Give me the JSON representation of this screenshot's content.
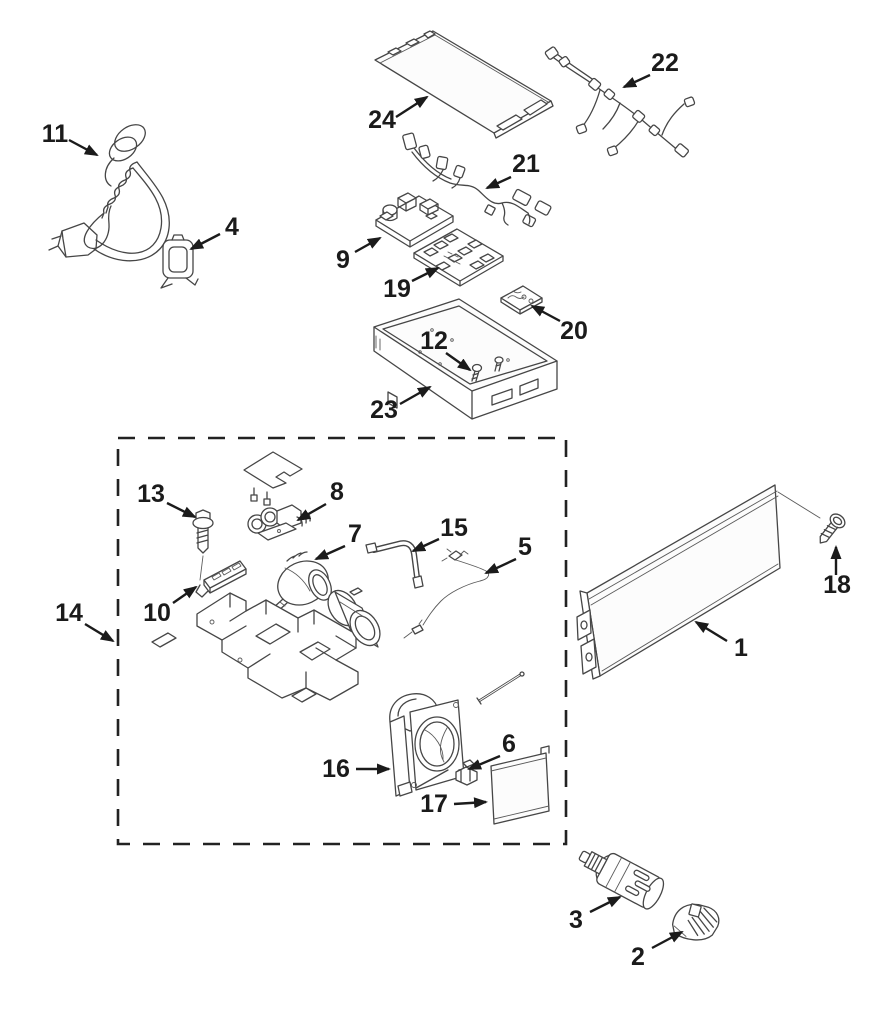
{
  "diagram": {
    "description": "Exploded appliance parts diagram with numbered callouts",
    "background": "#ffffff",
    "line_color": "#464646",
    "label_color": "#1b1b1b",
    "assembly_box": {
      "x": 118,
      "y": 438,
      "w": 448,
      "h": 406,
      "callout": "14"
    },
    "parts": [
      {
        "num": "1",
        "name": "grille-panel"
      },
      {
        "num": "2",
        "name": "filter-cap"
      },
      {
        "num": "3",
        "name": "water-filter"
      },
      {
        "num": "4",
        "name": "cord-clamp"
      },
      {
        "num": "5",
        "name": "thermistor-wire"
      },
      {
        "num": "6",
        "name": "clip"
      },
      {
        "num": "7",
        "name": "pump-motor"
      },
      {
        "num": "8",
        "name": "inlet-valve"
      },
      {
        "num": "9",
        "name": "power-board"
      },
      {
        "num": "10",
        "name": "led-board"
      },
      {
        "num": "11",
        "name": "power-cord"
      },
      {
        "num": "12",
        "name": "screws"
      },
      {
        "num": "13",
        "name": "hex-screw"
      },
      {
        "num": "14",
        "name": "assembly-group"
      },
      {
        "num": "15",
        "name": "tube"
      },
      {
        "num": "16",
        "name": "fan-assembly"
      },
      {
        "num": "17",
        "name": "cover-plate"
      },
      {
        "num": "18",
        "name": "screw"
      },
      {
        "num": "19",
        "name": "main-control-board"
      },
      {
        "num": "20",
        "name": "small-board"
      },
      {
        "num": "21",
        "name": "wire-harness-lower"
      },
      {
        "num": "22",
        "name": "wire-harness-upper"
      },
      {
        "num": "23",
        "name": "base-tray"
      },
      {
        "num": "24",
        "name": "top-panel"
      }
    ],
    "callouts": [
      {
        "num": "1",
        "tx": 741,
        "ty": 656,
        "x1": 727,
        "y1": 641,
        "x2": 696,
        "y2": 622
      },
      {
        "num": "2",
        "tx": 638,
        "ty": 965,
        "x1": 652,
        "y1": 948,
        "x2": 682,
        "y2": 932
      },
      {
        "num": "3",
        "tx": 576,
        "ty": 928,
        "x1": 590,
        "y1": 912,
        "x2": 620,
        "y2": 897
      },
      {
        "num": "4",
        "tx": 232,
        "ty": 235,
        "x1": 220,
        "y1": 234,
        "x2": 191,
        "y2": 249
      },
      {
        "num": "5",
        "tx": 525,
        "ty": 555,
        "x1": 516,
        "y1": 559,
        "x2": 486,
        "y2": 573
      },
      {
        "num": "6",
        "tx": 509,
        "ty": 752,
        "x1": 500,
        "y1": 756,
        "x2": 469,
        "y2": 769
      },
      {
        "num": "7",
        "tx": 355,
        "ty": 542,
        "x1": 345,
        "y1": 546,
        "x2": 316,
        "y2": 559
      },
      {
        "num": "8",
        "tx": 337,
        "ty": 500,
        "x1": 326,
        "y1": 504,
        "x2": 298,
        "y2": 520
      },
      {
        "num": "9",
        "tx": 343,
        "ty": 268,
        "x1": 355,
        "y1": 252,
        "x2": 380,
        "y2": 238
      },
      {
        "num": "10",
        "tx": 157,
        "ty": 621,
        "x1": 173,
        "y1": 603,
        "x2": 196,
        "y2": 587
      },
      {
        "num": "11",
        "tx": 55,
        "ty": 142,
        "x1": 69,
        "y1": 140,
        "x2": 97,
        "y2": 155
      },
      {
        "num": "12",
        "tx": 434,
        "ty": 349,
        "x1": 446,
        "y1": 353,
        "x2": 470,
        "y2": 370
      },
      {
        "num": "13",
        "tx": 151,
        "ty": 502,
        "x1": 167,
        "y1": 503,
        "x2": 195,
        "y2": 517
      },
      {
        "num": "14",
        "tx": 69,
        "ty": 621,
        "x1": 85,
        "y1": 624,
        "x2": 113,
        "y2": 641
      },
      {
        "num": "15",
        "tx": 454,
        "ty": 536,
        "x1": 439,
        "y1": 539,
        "x2": 413,
        "y2": 551
      },
      {
        "num": "16",
        "tx": 336,
        "ty": 777,
        "x1": 356,
        "y1": 769,
        "x2": 389,
        "y2": 769
      },
      {
        "num": "17",
        "tx": 434,
        "ty": 812,
        "x1": 454,
        "y1": 804,
        "x2": 486,
        "y2": 802
      },
      {
        "num": "18",
        "tx": 837,
        "ty": 593,
        "x1": 836,
        "y1": 575,
        "x2": 836,
        "y2": 547
      },
      {
        "num": "19",
        "tx": 397,
        "ty": 297,
        "x1": 412,
        "y1": 281,
        "x2": 438,
        "y2": 268
      },
      {
        "num": "20",
        "tx": 574,
        "ty": 339,
        "x1": 560,
        "y1": 321,
        "x2": 532,
        "y2": 306
      },
      {
        "num": "21",
        "tx": 526,
        "ty": 172,
        "x1": 511,
        "y1": 177,
        "x2": 487,
        "y2": 188
      },
      {
        "num": "22",
        "tx": 665,
        "ty": 71,
        "x1": 650,
        "y1": 75,
        "x2": 624,
        "y2": 87
      },
      {
        "num": "23",
        "tx": 384,
        "ty": 418,
        "x1": 400,
        "y1": 404,
        "x2": 430,
        "y2": 387
      },
      {
        "num": "24",
        "tx": 382,
        "ty": 128,
        "x1": 396,
        "y1": 117,
        "x2": 427,
        "y2": 97
      }
    ]
  }
}
